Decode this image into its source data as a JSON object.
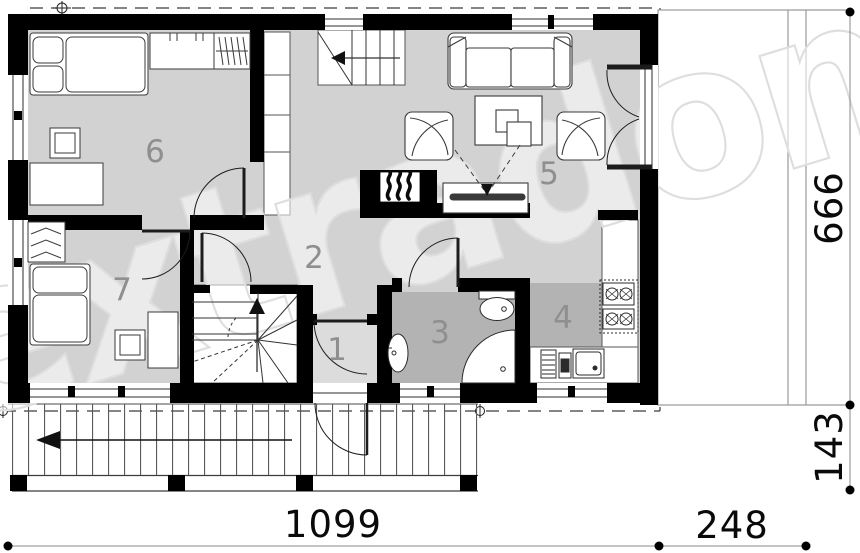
{
  "watermark": "extradom",
  "rooms": [
    {
      "number": "1"
    },
    {
      "number": "2"
    },
    {
      "number": "3"
    },
    {
      "number": "4"
    },
    {
      "number": "5"
    },
    {
      "number": "6"
    },
    {
      "number": "7"
    }
  ],
  "dimensions": {
    "bottom_main": "1099",
    "bottom_side": "248",
    "right_main": "666",
    "right_lower": "143"
  },
  "colors": {
    "wall": "#000000",
    "floor_light": "#d2d2d2",
    "floor_dark": "#b3b3b3",
    "floor_entry": "#dcdcdc",
    "label_gray": "#8f8f8f"
  }
}
